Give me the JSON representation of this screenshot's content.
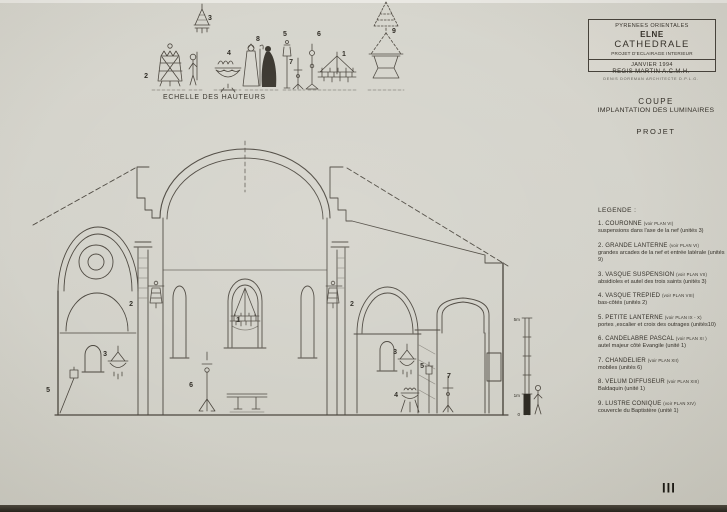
{
  "colors": {
    "paper": "#d3d2ca",
    "ink": "#45413a",
    "text": "#332f28"
  },
  "title_block": {
    "line1": "PYRENEES ORIENTALES",
    "line2": "ELNE",
    "line3": "CATHEDRALE",
    "line4": "PROJET D'ECLAIRAGE INTERIEUR",
    "line5": "JANVIER 1994",
    "architect_line1": "REGIS MARTIN  A.C.M.H.",
    "architect_line2": "DENIS DOREMAN  ARCHITECTE  D.P.L.G."
  },
  "sheet": {
    "title_line1": "COUPE",
    "title_line2": "IMPLANTATION DES LUMINAIRES",
    "phase": "PROJET",
    "page_number": "III"
  },
  "scale_row": {
    "caption": "ECHELLE DES HAUTEURS"
  },
  "legend": {
    "title": "LEGENDE :",
    "items": [
      {
        "name": "1. COURONNE",
        "ref": "(voir PLAN VI)",
        "desc": "suspensions dans l'axe de la nef  (unités 3)"
      },
      {
        "name": "2. GRANDE LANTERNE",
        "ref": "(voir PLAN VI)",
        "desc": "grandes arcades de la nef et entrée latérale (unités 9)"
      },
      {
        "name": "3. VASQUE SUSPENSION",
        "ref": "(voir PLAN VII)",
        "desc": "absidioles et autel des trois saints (unités  3)"
      },
      {
        "name": "4. VASQUE TREPIED",
        "ref": "(voir PLAN VIII)",
        "desc": "bas-côtés (unités  2)"
      },
      {
        "name": "5. PETITE LANTERNE",
        "ref": "(voir PLAN IX - X)",
        "desc": "portes ,escalier et croix des outrages (unités10)"
      },
      {
        "name": "6. CANDELABRE PASCAL",
        "ref": "(voir PLAN XI )",
        "desc": "autel majeur côté Evangile (unité 1)"
      },
      {
        "name": "7. CHANDELIER",
        "ref": "(voir PLAN XII)",
        "desc": "mobiles (unités  6)"
      },
      {
        "name": "8. VELUM DIFFUSEUR",
        "ref": "(voir PLAN XIII)",
        "desc": "Baldaquin (unité 1)"
      },
      {
        "name": "9. LUSTRE CONIQUE",
        "ref": "(voir PLAN XIV)",
        "desc": "couvercle du Baptistère (unité 1)"
      }
    ]
  },
  "markers": {
    "m1": "1",
    "m2": "2",
    "m3": "3",
    "m4": "4",
    "m5": "5",
    "m6": "6",
    "m7": "7",
    "m8": "8",
    "m9": "9"
  },
  "scale_bar": {
    "top": "5m",
    "mid": "1m",
    "zero": "0"
  }
}
